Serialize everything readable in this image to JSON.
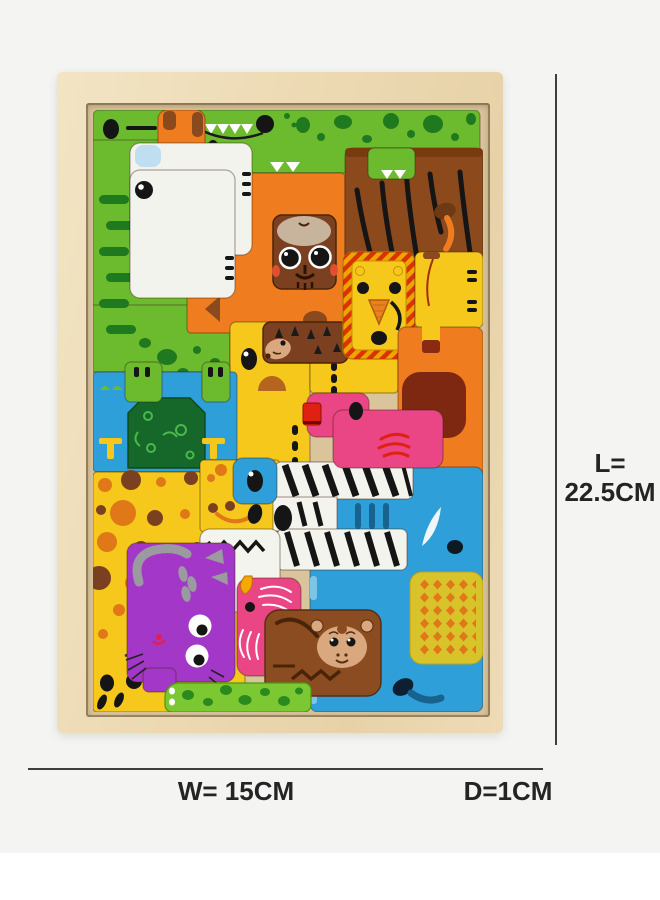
{
  "annotations": {
    "length": {
      "line1": "L=",
      "line2": "22.5CM"
    },
    "width": {
      "label": "W= 15CM"
    },
    "depth": {
      "label": "D=1CM"
    }
  },
  "photo": {
    "description": "Wooden tetris-style animal block puzzle in a wooden tray",
    "background_color": "#f4f4f2",
    "bottom_band_color": "#ffffff",
    "tray_wood_color": "#ecd9b2",
    "tray_well_color": "#d9c49c",
    "dimension_line_color": "#3f3f3f",
    "pieces": [
      {
        "name": "crocodile",
        "color": "#6cbb2e"
      },
      {
        "name": "fox",
        "color": "#ef7c1e"
      },
      {
        "name": "tiger",
        "color": "#8c4a1c"
      },
      {
        "name": "polar-bear",
        "color": "#f3f3ee"
      },
      {
        "name": "tiger-cub-face",
        "color": "#7a4020"
      },
      {
        "name": "goose",
        "color": "#f6c81c"
      },
      {
        "name": "hedgehog",
        "color": "#7a4020"
      },
      {
        "name": "lion",
        "color": "#f6c81c"
      },
      {
        "name": "camel",
        "color": "#f6c81c"
      },
      {
        "name": "bear",
        "color": "#ef7c1e"
      },
      {
        "name": "hippo",
        "color": "#2e9fd8"
      },
      {
        "name": "bush",
        "color": "#15682a"
      },
      {
        "name": "giraffe",
        "color": "#f6c81c"
      },
      {
        "name": "elephant",
        "color": "#2e9fd8"
      },
      {
        "name": "duck",
        "color": "#ea4585"
      },
      {
        "name": "zebra",
        "color": "#f4f4ef"
      },
      {
        "name": "cat",
        "color": "#a338c8"
      },
      {
        "name": "parrot",
        "color": "#ea4585"
      },
      {
        "name": "monkey",
        "color": "#8a4c20"
      },
      {
        "name": "snake",
        "color": "#7cc832"
      }
    ]
  }
}
